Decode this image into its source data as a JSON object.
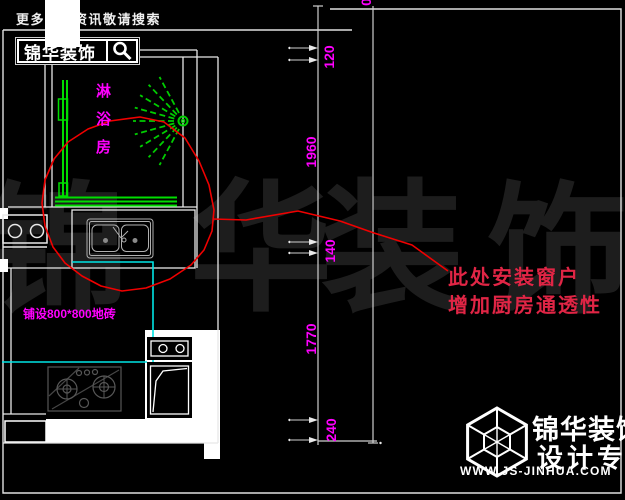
{
  "banner": {
    "promo_text": "更多装修资讯敬请搜索",
    "brand_text": "锦华装饰"
  },
  "plan": {
    "room_label": "淋浴房",
    "tile_note": "铺设800*800地砖"
  },
  "annotation": {
    "line1": "此处安装窗户",
    "line2": "增加厨房通透性"
  },
  "dimensions": [
    "120",
    "1960",
    "140",
    "1770",
    "240"
  ],
  "dimension_partial_top": "0",
  "watermark_chars": [
    "锦",
    "华",
    "装",
    "饰"
  ],
  "footer": {
    "brand": "锦华装饰",
    "tagline": "设计专家",
    "website": "WWW.JS-JINHUA.COM"
  },
  "colors": {
    "dimension_text": "#ff00ff",
    "annotation_red": "#e02545",
    "line_green": "#00dd00",
    "line_cyan": "#00e5e5",
    "curve_red": "#f00000",
    "linework": "#e8e8e8"
  }
}
